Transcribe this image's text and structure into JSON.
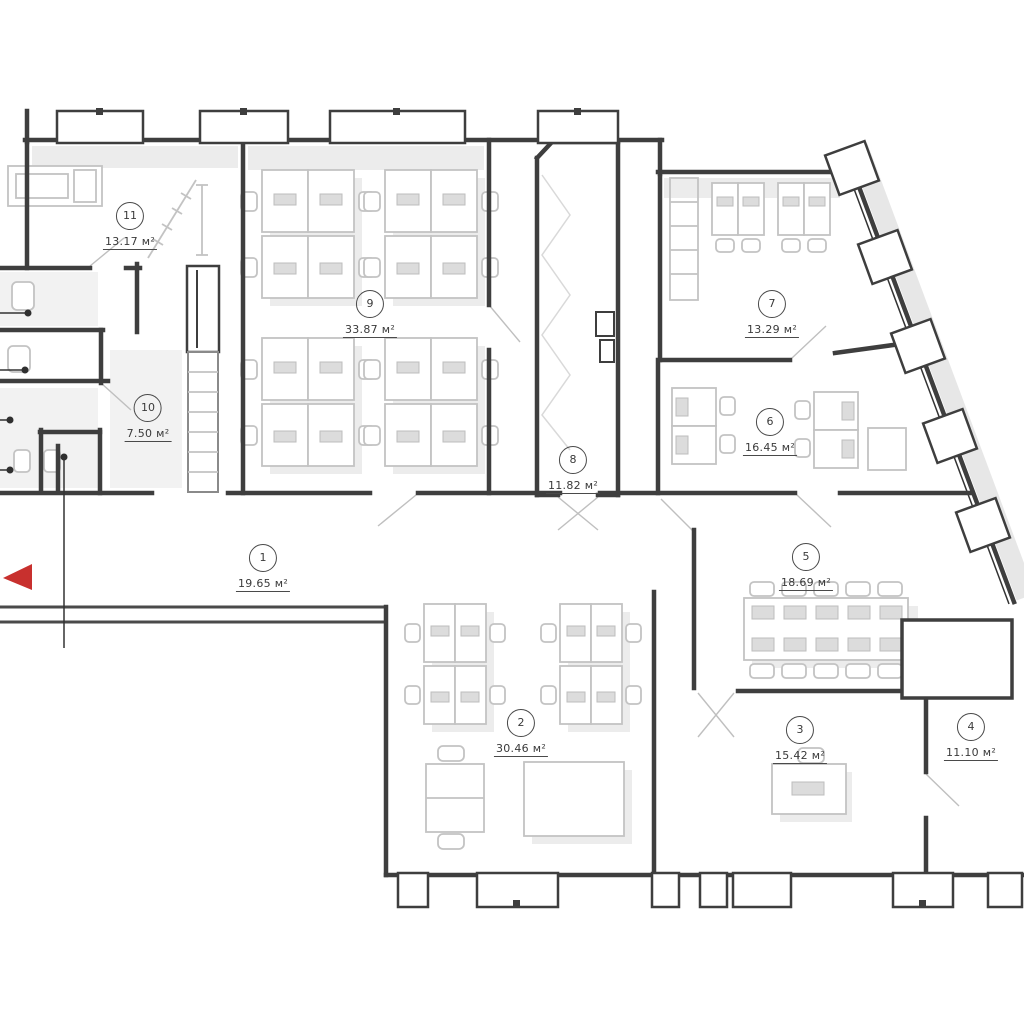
{
  "plan": {
    "kind": "office floor plan",
    "rooms": [
      {
        "number": "1",
        "area_label": "19.65 м²",
        "cx": 263,
        "cy": 544
      },
      {
        "number": "2",
        "area_label": "30.46 м²",
        "cx": 521,
        "cy": 709
      },
      {
        "number": "3",
        "area_label": "15.42 м²",
        "cx": 800,
        "cy": 716
      },
      {
        "number": "4",
        "area_label": "11.10 м²",
        "cx": 971,
        "cy": 713
      },
      {
        "number": "5",
        "area_label": "18.69 м²",
        "cx": 806,
        "cy": 543
      },
      {
        "number": "6",
        "area_label": "16.45 м²",
        "cx": 770,
        "cy": 408
      },
      {
        "number": "7",
        "area_label": "13.29 м²",
        "cx": 772,
        "cy": 290
      },
      {
        "number": "8",
        "area_label": "11.82 м²",
        "cx": 573,
        "cy": 446
      },
      {
        "number": "9",
        "area_label": "33.87 м²",
        "cx": 370,
        "cy": 290
      },
      {
        "number": "10",
        "area_label": "7.50 м²",
        "cx": 148,
        "cy": 394
      },
      {
        "number": "11",
        "area_label": "13.17 м²",
        "cx": 130,
        "cy": 202
      }
    ],
    "colors": {
      "wall": "#3e3e3e",
      "furniture": "#c3c3c3",
      "shadow": "#ececec",
      "text": "#3a3a3a",
      "entrance_arrow": "#c8302e"
    }
  }
}
